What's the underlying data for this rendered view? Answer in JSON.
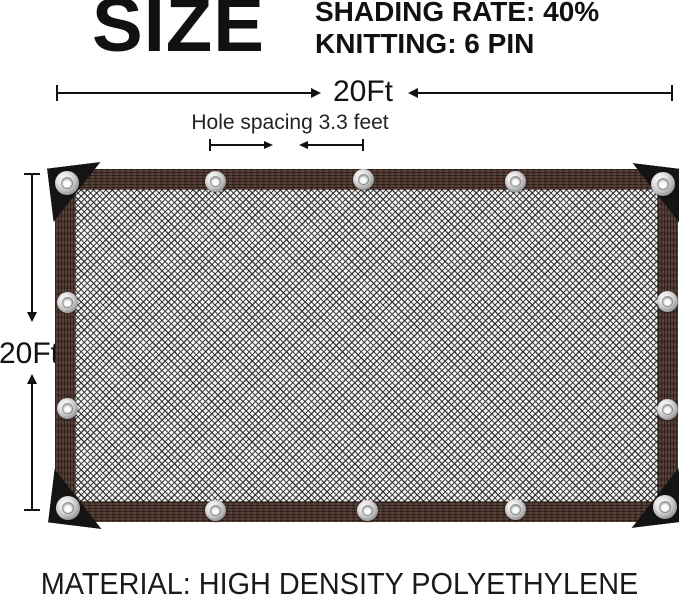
{
  "title": {
    "size": "SIZE"
  },
  "specs": {
    "shading_rate": "SHADING RATE: 40%",
    "knitting": "KNITTING: 6 PIN"
  },
  "dimensions": {
    "width": "20Ft",
    "height": "20Ft",
    "hole_spacing": "Hole spacing 3.3 feet"
  },
  "material": "MATERIAL: HIGH DENSITY POLYETHYLENE",
  "net": {
    "grommet_count": 14
  },
  "colors": {
    "ink": "#111111",
    "border-brown": "#4a332b",
    "mesh-bg": "#f5f5f5",
    "corner-black": "#141414",
    "grommet-silver": "#bdbdbd"
  }
}
